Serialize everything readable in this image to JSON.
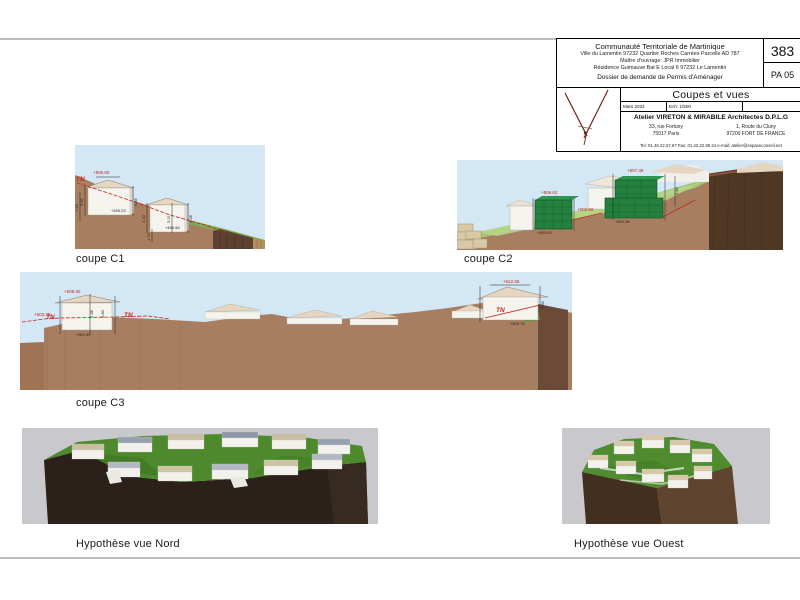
{
  "labels": {
    "c1": "coupe C1",
    "c2": "coupe C2",
    "c3": "coupe C3",
    "nord": "Hypothèse vue Nord",
    "ouest": "Hypothèse vue Ouest"
  },
  "title_block": {
    "org": "Communauté Territoriale de Martinique",
    "site": "Ville du Lamentin   97232 Quartier Roches Carrées Parcelle AD 787",
    "owner": "Maître d'ouvrage: JPR Immobilier",
    "owner_address": "Résidence Guimauve Bat E Local 6   97232 Le Lamentin",
    "dossier": "Dossier de demande de Permis d'Aménager",
    "sheet_number": "383",
    "sheet_code": "PA 05",
    "sheet_title": "Coupes et vues",
    "date": "Mars 2024",
    "scale": "Ech: 1/500",
    "architect": "Atelier VIRETON & MIRABILE Architectes D.P.L.G",
    "office1_line1": "33, rue Fortuny",
    "office1_line2": "75017  Paris",
    "office2_line1": "1, Route du Cluny",
    "office2_line2": "97200 FORT DE FRANCE",
    "contact": "Tel: 01.46.22.67.67    Fax: 01.42.22.89.24    e-mail: atelier@espaceconseil.net"
  },
  "annotations": {
    "c1": {
      "top": "+506.50",
      "tn": "TN",
      "base1": "+499.23",
      "base2": "+496.56",
      "d1": "5.52",
      "d2": "5.35",
      "d3": "1.45",
      "d4": "4.40",
      "d5": "5.21",
      "d6": "4.56",
      "d7": "1.70"
    },
    "c2": {
      "g1_top": "+506.62",
      "g1_base": "+500.03",
      "mid": "+502.60",
      "g2_top": "+507.38",
      "g2_base": "+502.38",
      "d1": "2.64"
    },
    "c3": {
      "l_top": "+508.30",
      "l_tn": "TN",
      "l_tn2": "TN",
      "l_left": "+503.30",
      "l_base": "+501.50",
      "l_d1": "1.36",
      "l_d2": "4.80",
      "r_top": "+512.56",
      "r_tn": "TN",
      "r_base": "+505.73",
      "r_d": "4.80"
    }
  },
  "colors": {
    "sky": "#d3e8f4",
    "sky3d": "#c9c9cd",
    "soil": "#a87e60",
    "cliff": "#5d4030",
    "cliff3d": "#2b211a",
    "grass": "#7cab51",
    "grass3d": "#4e8a2d",
    "bldg": "#f4f3ee",
    "bldg_side": "#d9d7d0",
    "roof": "#e5d5c1",
    "roof_blue": "#98a1b0",
    "gblock": "#23803f",
    "red": "#c2271a",
    "rule": "#bcbcbc",
    "ink": "#111111"
  }
}
